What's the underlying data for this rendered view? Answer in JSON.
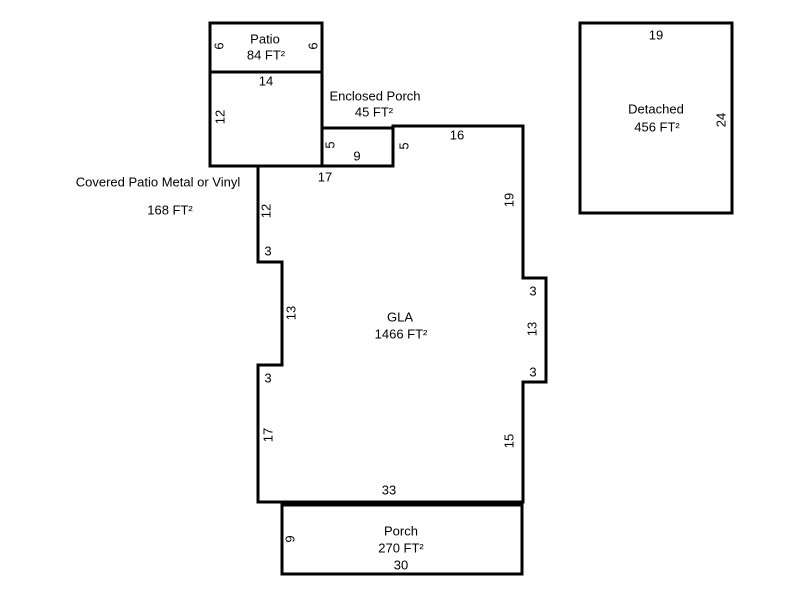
{
  "sketch": {
    "background_color": "#ffffff",
    "wall_color": "#000000",
    "text_color": "#000000",
    "rooms": {
      "patio": {
        "name": "Patio",
        "area": "84 FT²",
        "dims": {
          "left": "6",
          "right": "6",
          "bottom": "14"
        }
      },
      "covered_patio": {
        "name": "Covered Patio Metal or Vinyl",
        "area": "168 FT²",
        "dims": {
          "left": "12"
        }
      },
      "enclosed_porch": {
        "name": "Enclosed Porch",
        "area": "45 FT²",
        "dims": {
          "left": "5",
          "bottom": "9"
        }
      },
      "gla": {
        "name": "GLA",
        "area": "1466 FT²",
        "dims": {
          "top": "17",
          "step": "5",
          "top_right": "16",
          "right_upper": "19",
          "right_bump_top": "3",
          "right_bump": "13",
          "right_bump_bottom": "3",
          "right_lower": "15",
          "bottom": "33",
          "left_lower": "17",
          "left_notch_bottom": "3",
          "left_notch": "13",
          "left_notch_top": "3",
          "left_upper": "12"
        }
      },
      "porch": {
        "name": "Porch",
        "area": "270 FT²",
        "dims": {
          "left": "9",
          "bottom": "30"
        }
      },
      "detached": {
        "name": "Detached",
        "area": "456 FT²",
        "dims": {
          "top": "19",
          "right": "24"
        }
      }
    }
  }
}
